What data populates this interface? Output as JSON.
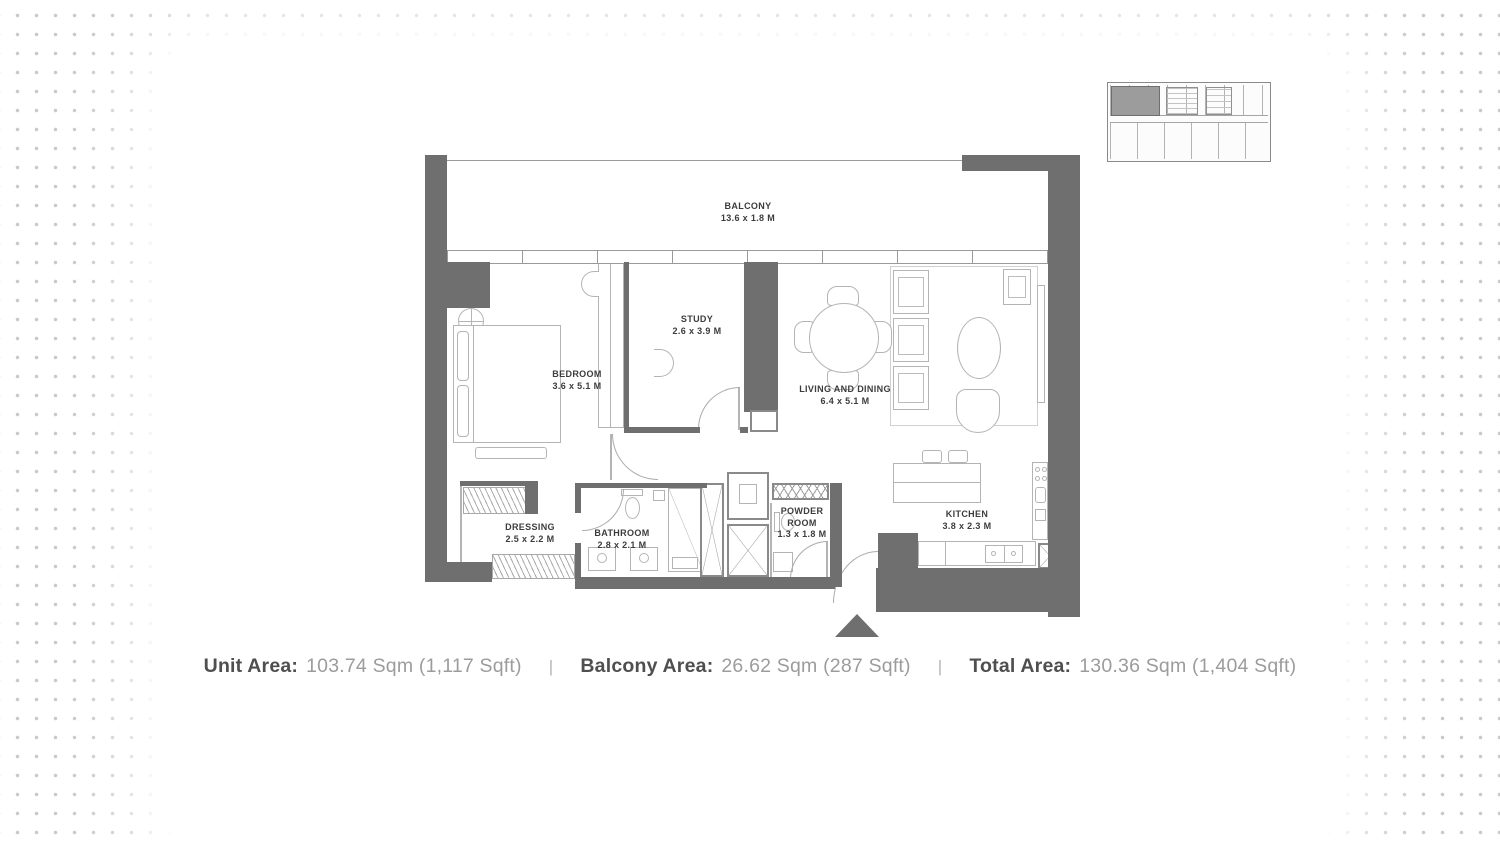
{
  "key_plan": {
    "description": "building level key plan with current unit highlighted"
  },
  "rooms": {
    "balcony": {
      "label": "BALCONY",
      "dims": "13.6 x 1.8 M"
    },
    "bedroom": {
      "label": "BEDROOM",
      "dims": "3.6 x 5.1 M"
    },
    "study": {
      "label": "STUDY",
      "dims": "2.6 x 3.9 M"
    },
    "living_dining": {
      "label": "LIVING AND DINING",
      "dims": "6.4 x 5.1 M"
    },
    "kitchen": {
      "label": "KITCHEN",
      "dims": "3.8 x 2.3 M"
    },
    "dressing": {
      "label": "DRESSING",
      "dims": "2.5 x 2.2 M"
    },
    "bathroom": {
      "label": "BATHROOM",
      "dims": "2.8 x 2.1 M"
    },
    "powder_room": {
      "label_line1": "POWDER",
      "label_line2": "ROOM",
      "dims": "1.3 x 1.8 M"
    }
  },
  "area_summary": {
    "separator": "|",
    "unit_area": {
      "label": "Unit Area:",
      "value": "103.74 Sqm (1,117 Sqft)"
    },
    "balcony_area": {
      "label": "Balcony Area:",
      "value": "26.62 Sqm (287 Sqft)"
    },
    "total_area": {
      "label": "Total Area:",
      "value": "130.36 Sqm (1,404 Sqft)"
    }
  },
  "colors": {
    "wall": "#6f6f6f",
    "room_label_text": "#3c3c3c",
    "summary_label": "#4f4f4f",
    "summary_value": "#9c9c9c",
    "background_dots": "#c9c9c9",
    "key_plan_highlight": "#9c9c9c"
  }
}
